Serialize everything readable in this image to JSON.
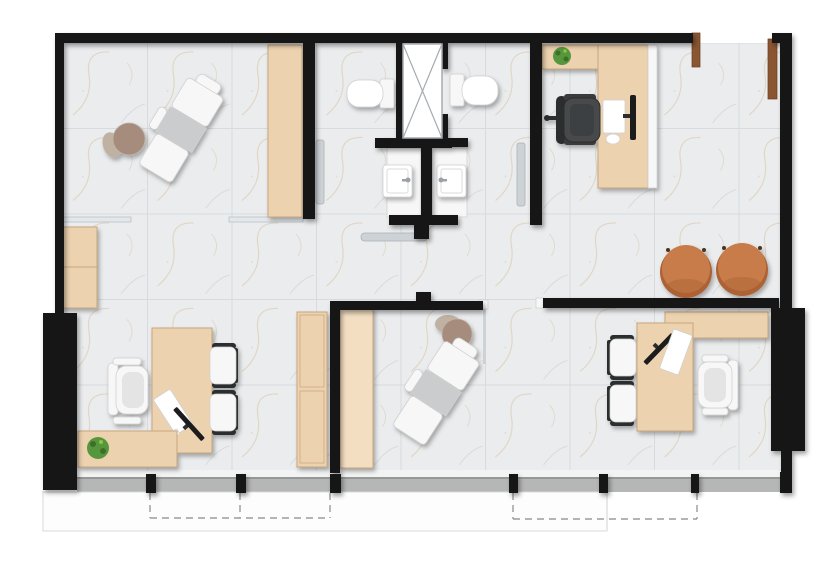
{
  "plan": {
    "description": "top-down office / clinic floor plan with marble tile floor",
    "canvas": {
      "width": 839,
      "height": 562
    },
    "rooms": [
      "consultation-room-nw",
      "wc-left",
      "wc-right",
      "elevator-shaft",
      "reception-office-ne",
      "waiting-area",
      "office-sw",
      "treatment-room-s",
      "office-se",
      "balcony-terrace"
    ],
    "furniture_counts": {
      "treatment_chairs": 2,
      "rolling_stools": 2,
      "desks": 4,
      "task_chairs": 3,
      "guest_chairs": 4,
      "poufs": 2,
      "toilets": 2,
      "sinks": 2,
      "plants": 3,
      "cabinets": 6,
      "elevators": 1
    }
  },
  "palette": {
    "wall": "#161616",
    "floor": "#eaecee",
    "floor_line": "#d8dbdd",
    "floor_vein": "#d8c5a4",
    "floor_vein2": "#c6ccce",
    "wood": "#edd2b0",
    "wood_light": "#f3dec2",
    "wood_edge": "#c8a67d",
    "door_wood": "#8a5632",
    "door_wood_edge": "#6e3f20",
    "white_item": "#f7f7f7",
    "white_bright": "#ffffff",
    "item_edge": "#cfcfcf",
    "seat_gray": "#cbcccd",
    "chrome": "#cdd2d7",
    "chrome_edge": "#aab0b5",
    "glass": "#e3e7ea",
    "glass_edge": "#b9bfc4",
    "chair_black": "#2c2d2f",
    "chair_black_seat": "#47484b",
    "chair_black_arm": "#3a3b3d",
    "chair_black_inner": "#3e4042",
    "monitor_black": "#1d1d1f",
    "pouf": "#c87c4a",
    "pouf_dark": "#ad6234",
    "pouf_foot": "#4a3524",
    "stool": "#a58c7d",
    "stool_light": "#bfb2a3",
    "plant": "#57963e",
    "plant_dark": "#3c7028",
    "plant_light": "#8cc63f",
    "balcony": "#b5b6b6",
    "balcony_edge": "#969797",
    "slab": "#fdfdfd",
    "slab_edge": "#d9d9d9",
    "dashed": "#9b9b9b",
    "sill": "#f2f3f3",
    "elevator_line": "#a6abb0",
    "faucet": "#9ba1a6"
  }
}
